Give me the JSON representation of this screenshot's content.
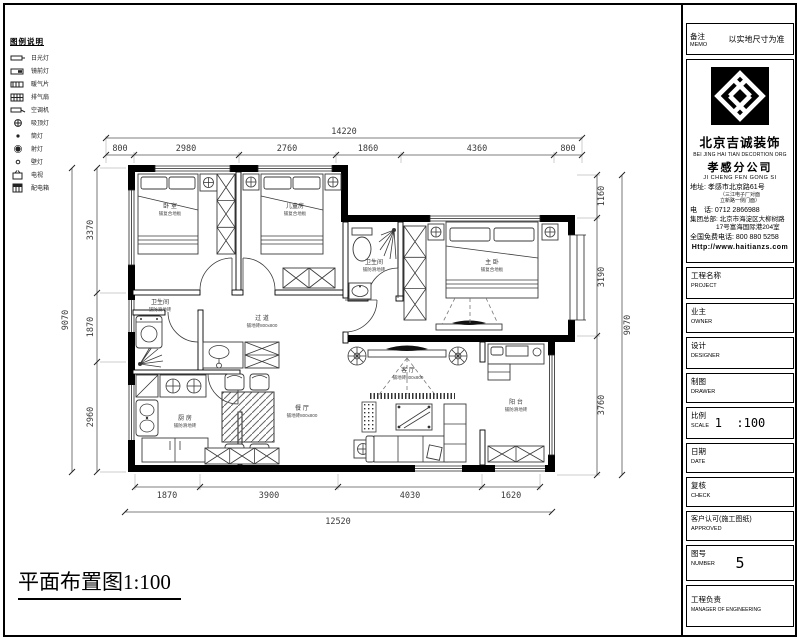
{
  "sheet": {
    "plan_title": "平面布置图1:100"
  },
  "memo": {
    "label_cn": "备注",
    "label_en": "MEMO",
    "text": "以实地尺寸为准"
  },
  "company": {
    "name_cn": "北京吉诚装饰",
    "name_en": "BEI JING HAI TIAN DECORTION ORG",
    "branch_cn": "孝感分公司",
    "branch_en": "JI CHENG FEN GONG SI",
    "address_label": "地址:",
    "address": "孝感市北京路61号",
    "address_note1": "（三江电子厂对面",
    "address_note2": "立新路一侧门面）",
    "phone_label": "电　话:",
    "phone": "0712 2866988",
    "hq_label": "集团总部:",
    "hq_line1": "北京市海淀区大柳树路",
    "hq_line2": "17号富海国际港204室",
    "hotline_label": "全国免费电话:",
    "hotline": "800 880 5258",
    "website": "Http://www.haitianzs.com"
  },
  "titleblock": {
    "rows": [
      {
        "cn": "工程名称",
        "en": "PROJECT",
        "value": ""
      },
      {
        "cn": "业主",
        "en": "OWNER",
        "value": ""
      },
      {
        "cn": "设计",
        "en": "DESIGNER",
        "value": ""
      },
      {
        "cn": "制图",
        "en": "DRAWER",
        "value": ""
      },
      {
        "cn": "比例",
        "en": "SCALE",
        "value": "1  :100"
      },
      {
        "cn": "日期",
        "en": "DATE",
        "value": ""
      },
      {
        "cn": "复核",
        "en": "CHECK",
        "value": ""
      },
      {
        "cn": "客户认可(施工图纸)",
        "en": "APPROVED",
        "value": ""
      },
      {
        "cn": "图号",
        "en": "NUMBER",
        "value": "5"
      },
      {
        "cn": "工程负责",
        "en": "MANAGER OF ENGINEERING",
        "value": ""
      }
    ]
  },
  "legend": {
    "title": "图例说明",
    "items": [
      {
        "label": "日光灯"
      },
      {
        "label": "镜前灯"
      },
      {
        "label": "暖气片"
      },
      {
        "label": "排气扇"
      },
      {
        "label": "空调机"
      },
      {
        "label": "吸顶灯"
      },
      {
        "label": "筒灯"
      },
      {
        "label": "射灯"
      },
      {
        "label": "壁灯"
      },
      {
        "label": "电视"
      },
      {
        "label": "配电箱"
      }
    ]
  },
  "dims": {
    "top_total": "14220",
    "top": [
      "800",
      "2980",
      "2760",
      "1860",
      "4360",
      "800"
    ],
    "bottom_total": "12520",
    "bottom": [
      "1870",
      "3900",
      "4030",
      "1620"
    ],
    "left_total": "9070",
    "left": [
      "3370",
      "1870",
      "2960"
    ],
    "right_total": "9070",
    "right": [
      "1160",
      "3190",
      "3760"
    ]
  },
  "rooms": {
    "bed1": {
      "name": "卧 室",
      "floor": "铺复合地板"
    },
    "bed2": {
      "name": "儿童房",
      "floor": "铺复合地板"
    },
    "mbath": {
      "name": "卫生间",
      "floor": "铺防滑地砖"
    },
    "mbed": {
      "name": "主 卧",
      "floor": "铺复合地板"
    },
    "hall": {
      "name": "过 道",
      "floor": "铺地砖800x800"
    },
    "bath2": {
      "name": "卫生间",
      "floor": "铺防滑地砖"
    },
    "kitchen": {
      "name": "厨 房",
      "floor": "铺防滑地砖"
    },
    "dining": {
      "name": "餐 厅",
      "floor": "铺地砖800x800"
    },
    "living": {
      "name": "客 厅",
      "floor": "铺地砖800x800"
    },
    "balcony": {
      "name": "阳 台",
      "floor": "铺防滑地砖"
    }
  }
}
